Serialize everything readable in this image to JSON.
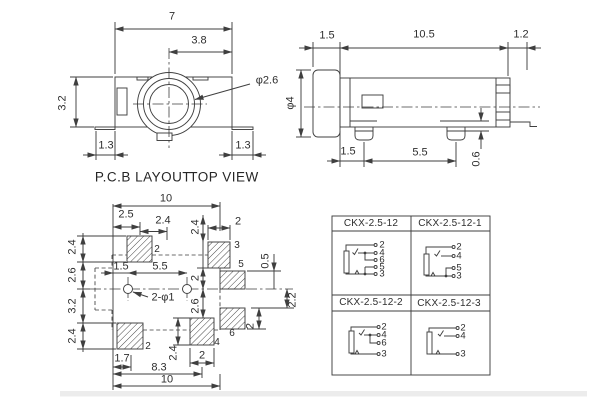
{
  "captions": {
    "pcb_layout": "P.C.B LAYOUT",
    "top_view": "TOP VIEW"
  },
  "top_view": {
    "overall_width": "7",
    "center_to_edge": "3.8",
    "body_height": "3.2",
    "foot_left": "1.3",
    "foot_right": "1.3",
    "jack_bore": "φ2.6"
  },
  "side_view": {
    "front_offset": "1.5",
    "body_length": "10.5",
    "tail": "1.2",
    "barrel_dia": "φ4",
    "pin1_offset": "1.5",
    "pin_pitch": "5.5",
    "lead_height": "0.6"
  },
  "pcb_layout": {
    "overall_top": "10",
    "pad2_center": "2.5",
    "pad2_width": "2.4",
    "col_height": "2.4",
    "pad3_width": "2",
    "left_chain": [
      "2.4",
      "2.6",
      "3.2",
      "2.4"
    ],
    "hole_offset": "1.5",
    "hole_pitch": "5.5",
    "holes": "2-φ1",
    "pad3_to_center": "2",
    "center_to_pad4": "2.6",
    "pad_gap": "0.5",
    "center_to_pad6": "2.2",
    "pad6_height": "2",
    "pad2b_offset": "1.7",
    "pad4_height": "2.4",
    "pad4_width": "2",
    "to_pad4_center": "8.3",
    "overall_bottom": "10",
    "pad_labels": {
      "top_left": "2",
      "top_right": "3",
      "right_upper": "5",
      "right_lower": "6",
      "bottom_center": "4",
      "bottom_left": "2"
    }
  },
  "table": {
    "cells": [
      {
        "title": "CKX-2.5-12",
        "pins": [
          "2",
          "4",
          "6",
          "5",
          "3"
        ]
      },
      {
        "title": "CKX-2.5-12-1",
        "pins": [
          "2",
          "4",
          "5",
          "3"
        ]
      },
      {
        "title": "CKX-2.5-12-2",
        "pins": [
          "2",
          "4",
          "6",
          "3"
        ]
      },
      {
        "title": "CKX-2.5-12-3",
        "pins": [
          "2",
          "4",
          "3"
        ]
      }
    ]
  },
  "colors": {
    "line": "#3f3f3f",
    "text": "#2e2e2e",
    "hatch": "#5a5a5a",
    "band": "#ececec"
  }
}
